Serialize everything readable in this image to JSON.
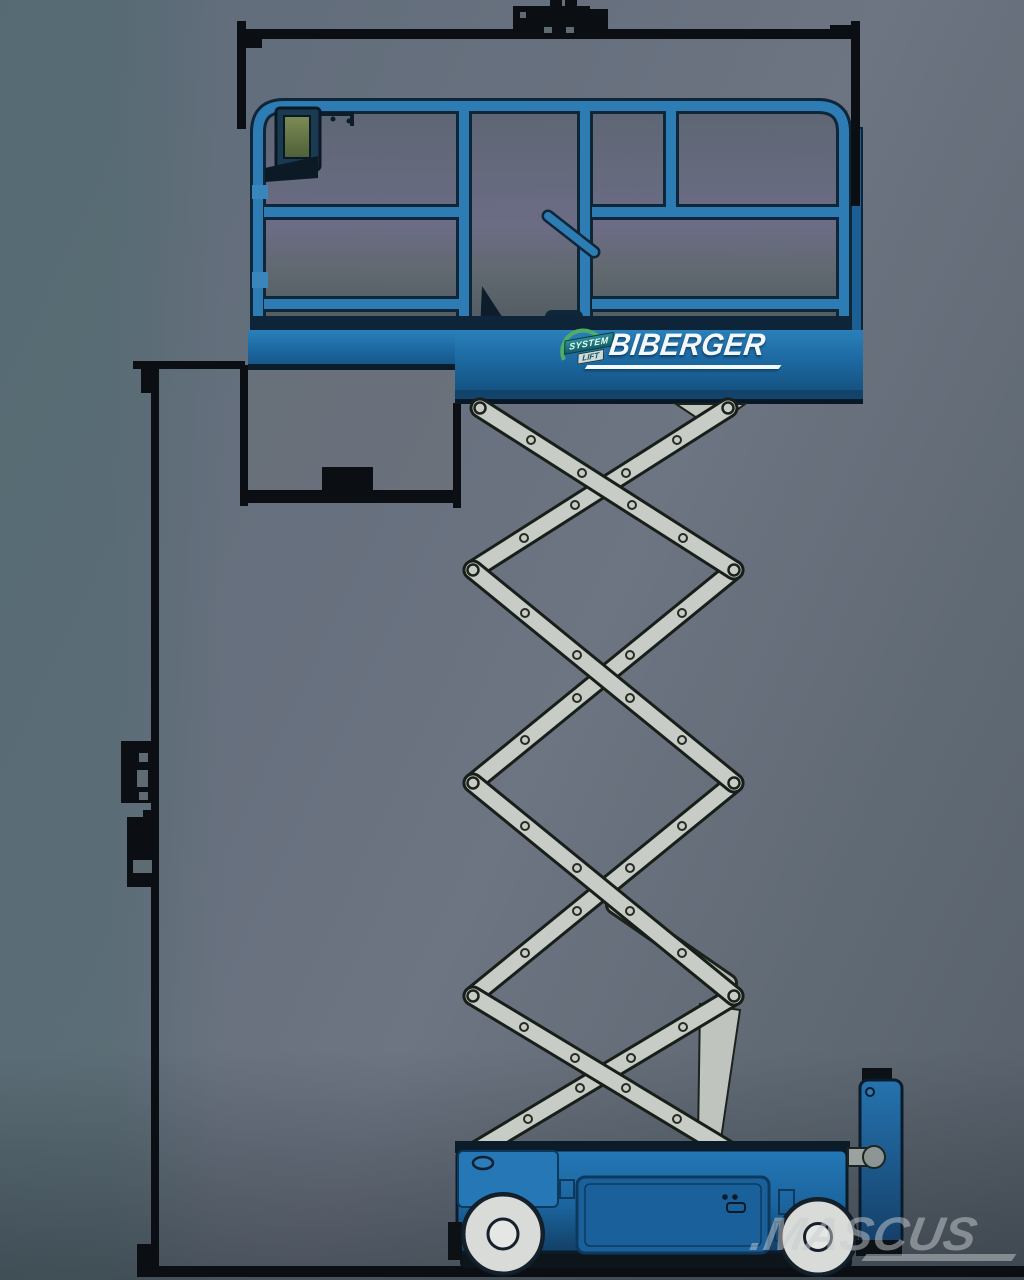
{
  "branding": {
    "logo_text": "BIBERGER",
    "badge": {
      "line1": "SYSTEM",
      "line2": "LIFT"
    },
    "watermark_text": ".MASCUS"
  },
  "figure": {
    "subject": "scissor-lift-side-view-technical-diagram",
    "elements": [
      "platform-with-guardrails",
      "platform-control-box",
      "scissor-mechanism",
      "wheeled-chassis",
      "dimension-lines",
      "ground-line"
    ]
  },
  "colors": {
    "machine_blue": "#2e7cb4",
    "machine_blue_dark": "#155a8d",
    "band_blue": "#1d6aa3",
    "outline_dark": "#0b1c2c",
    "arm_gray": "#c8ccc7",
    "wheel_gray": "#d8dbd7",
    "drawing_black": "#0b0f13",
    "logo_white": "#f4f8fb",
    "watermark_gray": "#c7ccd0",
    "badge_green": "#4fae66",
    "badge_teal": "#2a8f96",
    "screen_green": "#76854e"
  }
}
